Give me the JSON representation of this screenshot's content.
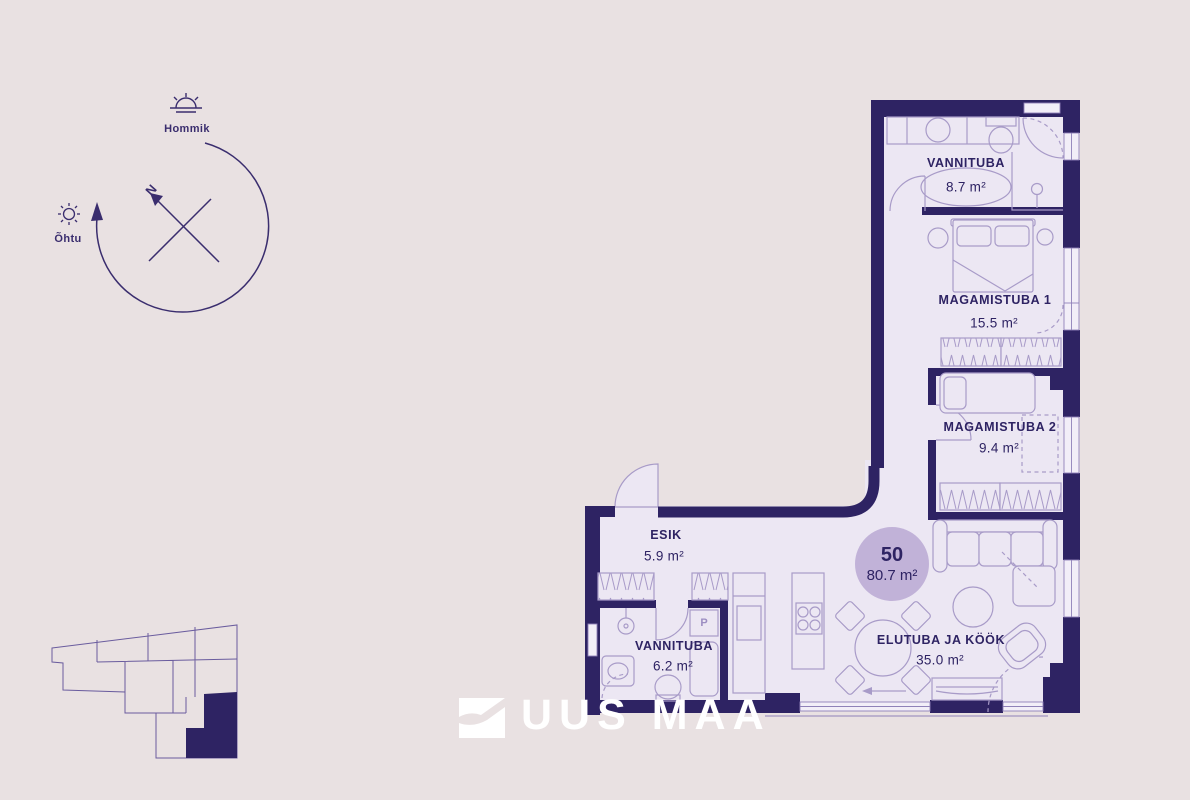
{
  "apartment": {
    "number": "50",
    "total_area": "80.7 m²"
  },
  "rooms": [
    {
      "name": "VANNITUBA",
      "area": "8.7 m²"
    },
    {
      "name": "MAGAMISTUBA 1",
      "area": "15.5 m²"
    },
    {
      "name": "MAGAMISTUBA 2",
      "area": "9.4 m²"
    },
    {
      "name": "ESIK",
      "area": "5.9 m²"
    },
    {
      "name": "VANNITUBA",
      "area": "6.2 m²"
    },
    {
      "name": "ELUTUBA JA KÖÖK",
      "area": "35.0 m²"
    }
  ],
  "compass": {
    "north": "N",
    "morning": "Hommik",
    "evening": "Õhtu"
  },
  "labels": {
    "washing_machine": "P"
  },
  "logo": {
    "text": "UUS MAA"
  },
  "colors": {
    "background": "#e9e1e2",
    "wall": "#2e2363",
    "floor": "#ece7f3",
    "furniture_line": "#a89bc8",
    "badge": "#c1b2d8",
    "text": "#2e2363",
    "logo": "#ffffff"
  }
}
